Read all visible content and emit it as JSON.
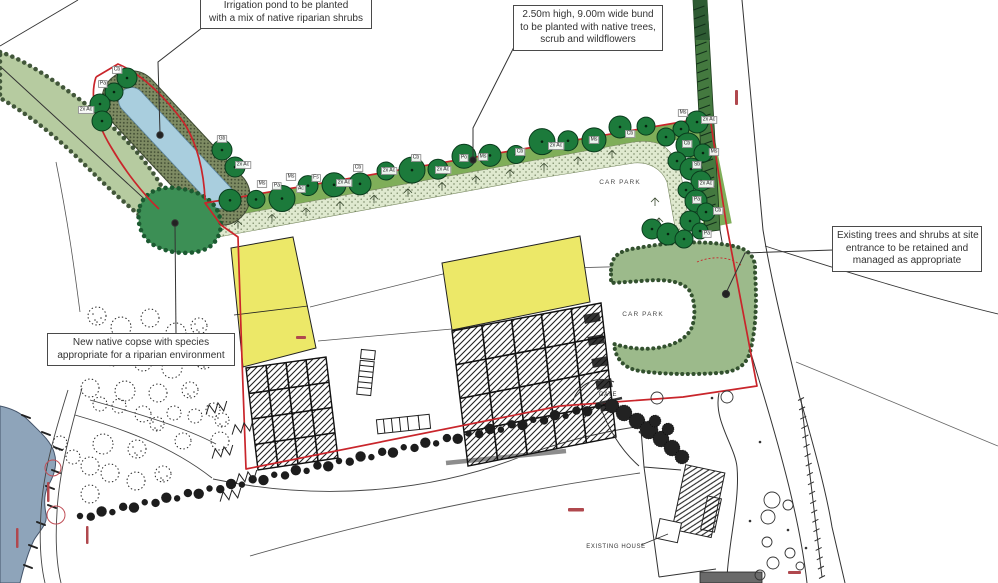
{
  "callouts": {
    "irrigation_pond": {
      "line1": "Irrigation pond to be planted",
      "line2": "with a mix of native riparian shrubs"
    },
    "bund": {
      "line1": "2.50m high, 9.00m wide bund",
      "line2": "to be planted with native trees,",
      "line3": "scrub and wildflowers"
    },
    "existing_trees": {
      "line1": "Existing trees and shrubs at site",
      "line2": "entrance to be retained and",
      "line3": "managed as appropriate"
    },
    "copse": {
      "line1": "New native copse with species",
      "line2": "appropriate for a riparian environment"
    }
  },
  "labels": {
    "car_park_upper": "CAR PARK",
    "car_park_lower": "CAR PARK",
    "gate": "GATE",
    "existing_house": "EXISTING HOUSE"
  },
  "tree_tags": [
    {
      "t": "Cb",
      "x": 117,
      "y": 70
    },
    {
      "t": "Pa",
      "x": 103,
      "y": 84
    },
    {
      "t": "2x Ac",
      "x": 86,
      "y": 110
    },
    {
      "t": "Gb",
      "x": 222,
      "y": 139
    },
    {
      "t": "2x Ac",
      "x": 243,
      "y": 165
    },
    {
      "t": "Ms",
      "x": 262,
      "y": 184
    },
    {
      "t": "Pa",
      "x": 277,
      "y": 186
    },
    {
      "t": "Ms",
      "x": 291,
      "y": 177
    },
    {
      "t": "Ac",
      "x": 301,
      "y": 189
    },
    {
      "t": "Fs",
      "x": 316,
      "y": 178
    },
    {
      "t": "2x Ac",
      "x": 344,
      "y": 183
    },
    {
      "t": "Cb",
      "x": 358,
      "y": 168
    },
    {
      "t": "2x Ac",
      "x": 389,
      "y": 171
    },
    {
      "t": "Cb",
      "x": 416,
      "y": 158
    },
    {
      "t": "2x Ac",
      "x": 443,
      "y": 170
    },
    {
      "t": "Po",
      "x": 464,
      "y": 158
    },
    {
      "t": "Ms",
      "x": 483,
      "y": 157
    },
    {
      "t": "Cb",
      "x": 520,
      "y": 152
    },
    {
      "t": "2x Ac",
      "x": 556,
      "y": 146
    },
    {
      "t": "Ms",
      "x": 594,
      "y": 140
    },
    {
      "t": "Cb",
      "x": 630,
      "y": 134
    },
    {
      "t": "Ms",
      "x": 683,
      "y": 113
    },
    {
      "t": "2x Ac",
      "x": 709,
      "y": 120
    },
    {
      "t": "Cb",
      "x": 687,
      "y": 144
    },
    {
      "t": "Ms",
      "x": 714,
      "y": 152
    },
    {
      "t": "Sb",
      "x": 697,
      "y": 165
    },
    {
      "t": "2x Ac",
      "x": 706,
      "y": 184
    },
    {
      "t": "Pa",
      "x": 697,
      "y": 200
    },
    {
      "t": "Cb",
      "x": 718,
      "y": 211
    },
    {
      "t": "Pa",
      "x": 707,
      "y": 234
    }
  ],
  "colors": {
    "boundary_red": "#c9252b",
    "bund_green": "#7fae59",
    "tree_green": "#1c7a3b",
    "blob_green": "#9cba8b",
    "copse_green": "#3c8f55",
    "belt_green": "#b6cba0",
    "pond_water": "#a9cede",
    "pond_band": "#7e8b63",
    "wildflower": "#dfe9cf",
    "hedge_strip": "#44793f",
    "building_yellow": "#ece868",
    "water_grey": "#8ea4ba"
  }
}
